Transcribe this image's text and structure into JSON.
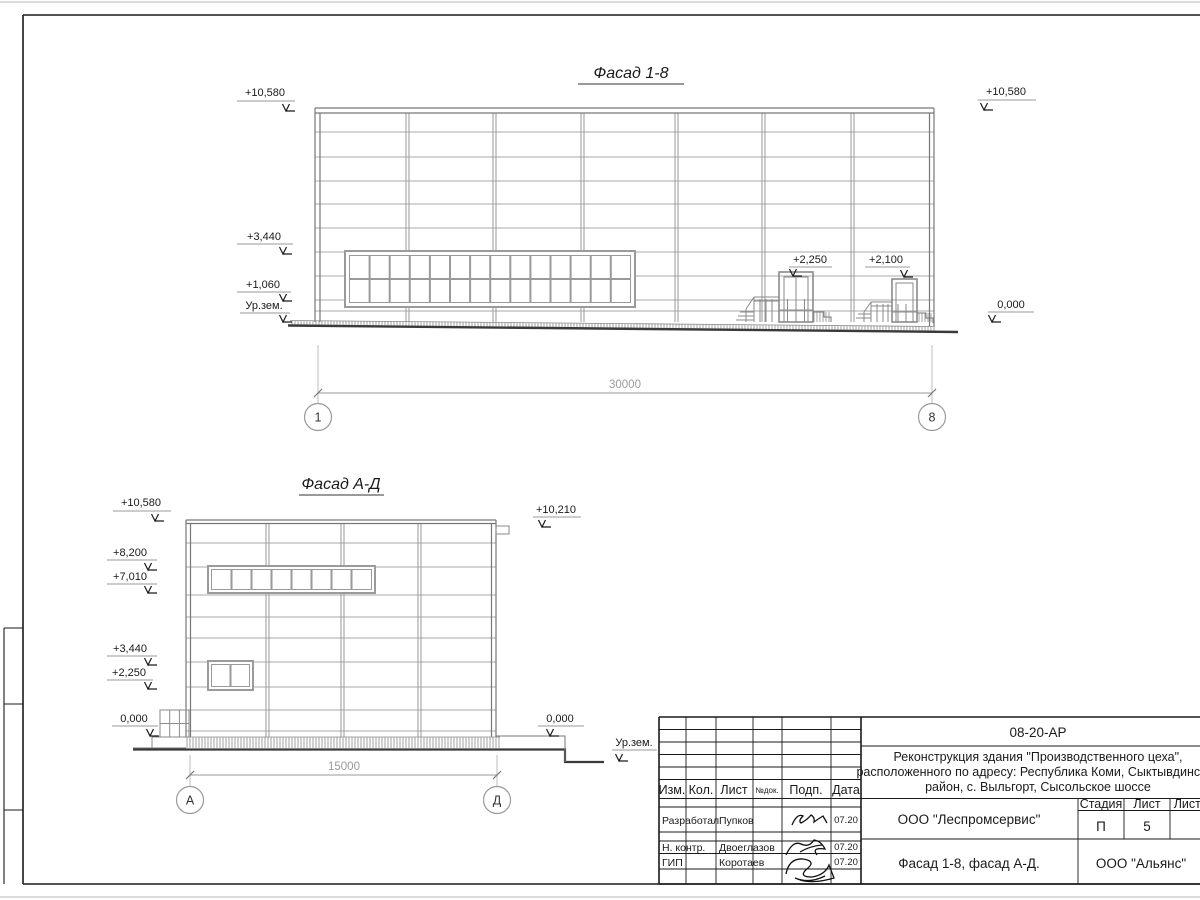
{
  "facade_1_8": {
    "title": "Фасад 1-8",
    "marks": {
      "left_top": "+10,580",
      "left_mid": "+3,440",
      "left_low": "+1,060",
      "left_ground": "Ур.зем.",
      "right_top": "+10,580",
      "right_zero": "0,000",
      "entry_left": "+2,250",
      "entry_right": "+2,100"
    },
    "dimension": "30000",
    "axis_start": "1",
    "axis_end": "8"
  },
  "facade_a_d": {
    "title": "Фасад А-Д",
    "marks": {
      "left_top": "+10,580",
      "left_1": "+8,200",
      "left_2": "+7,010",
      "left_3": "+3,440",
      "left_4": "+2,250",
      "left_zero": "0,000",
      "right_top": "+10,210",
      "right_zero": "0,000",
      "right_ground": "Ур.зем."
    },
    "dimension": "15000",
    "axis_start": "А",
    "axis_end": "Д"
  },
  "title_block": {
    "doc_number": "08-20-АР",
    "project_line1": "Реконструкция здания \"Производственного цеха\",",
    "project_line2": "расположенного по адресу: Республика Коми, Сыктывдинский",
    "project_line3": "район, с. Выльгорт, Сысольское шоссе",
    "columns": {
      "izm": "Изм.",
      "kol": "Кол.",
      "list": "Лист",
      "ndoc": "№док.",
      "podp": "Подп.",
      "data": "Дата"
    },
    "rows": [
      {
        "role": "Разработал",
        "name": "Пупков",
        "date": "07.20"
      },
      {
        "role": "Н. контр.",
        "name": "Двоеглазов",
        "date": "07.20"
      },
      {
        "role": "ГИП",
        "name": "Коротаев",
        "date": "07.20"
      }
    ],
    "org_designer": "ООО \"Леспромсервис\"",
    "stage_label": "Стадия",
    "sheet_label": "Лист",
    "sheets_label": "Листов",
    "stage_value": "П",
    "sheet_value": "5",
    "sheet_title": "Фасад 1-8, фасад А-Д.",
    "org_customer": "ООО \"Альянс\""
  },
  "colors": {
    "panel_line": "#a8a8a8",
    "outline": "#777777",
    "ground": "#3a3a3a",
    "dim_gray": "#9a9a9a",
    "frame_black": "#1a1a1a"
  }
}
